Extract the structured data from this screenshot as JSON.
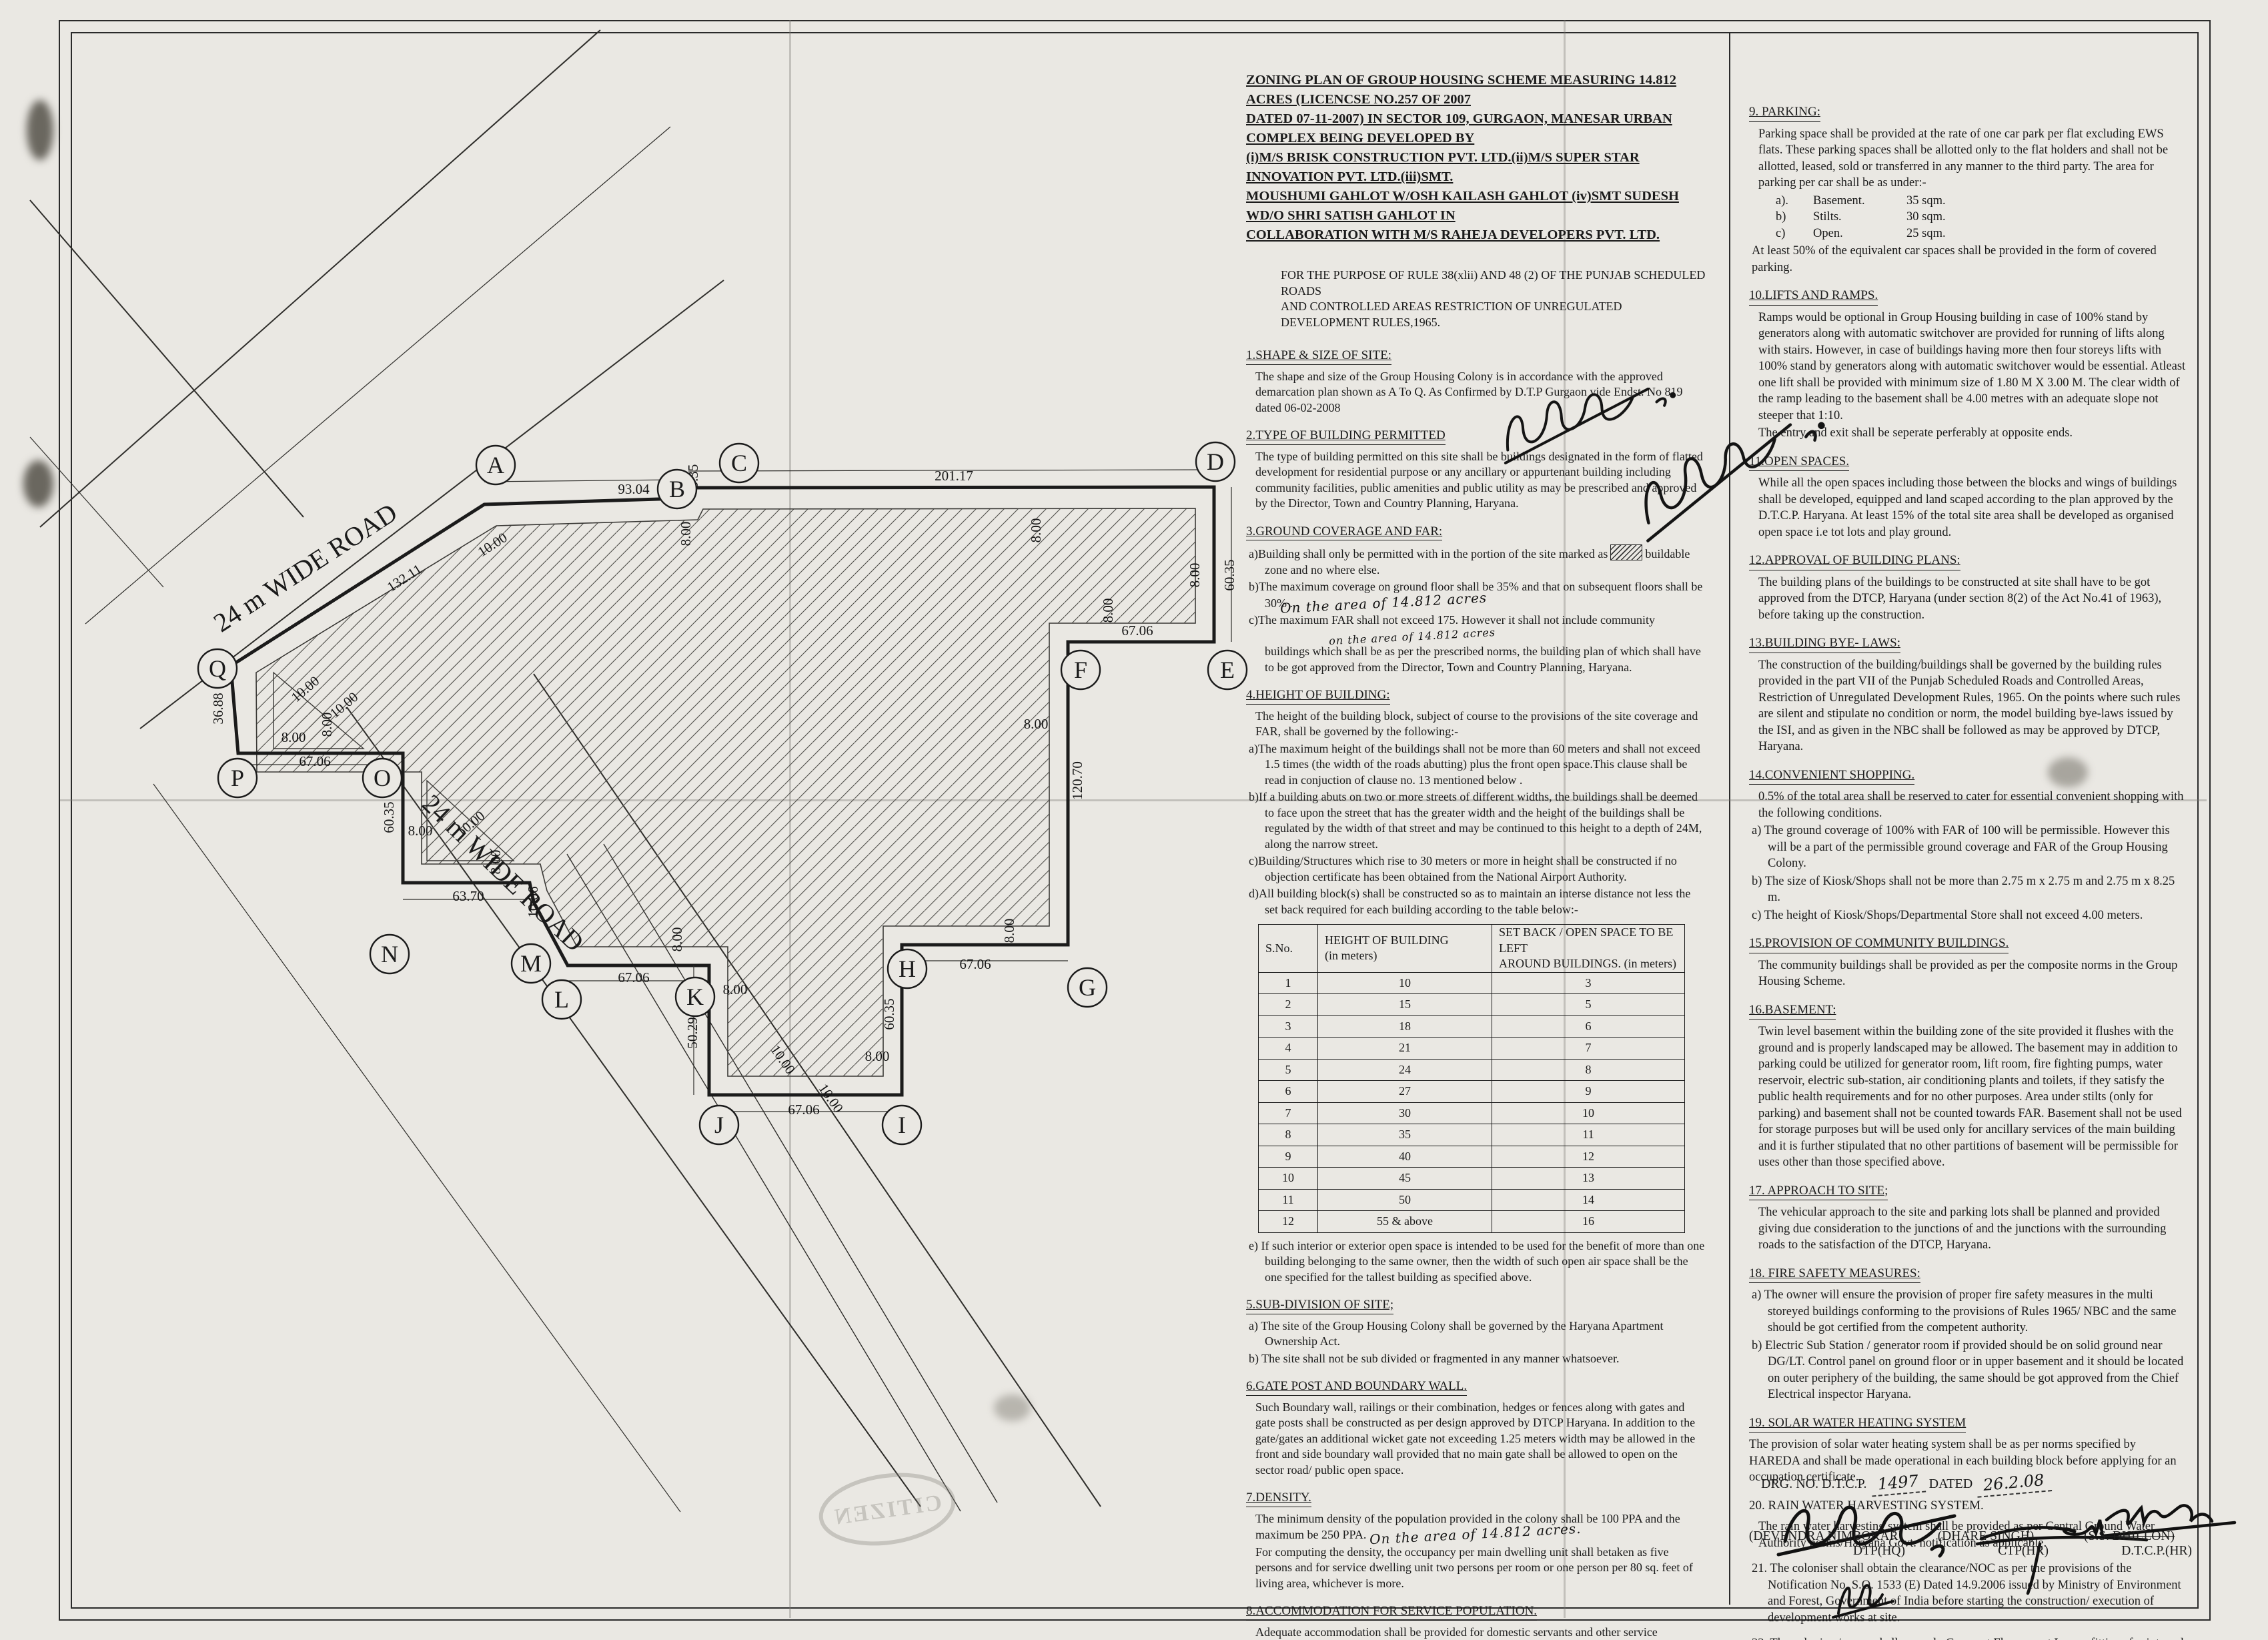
{
  "title_lines": [
    "ZONING PLAN OF GROUP HOUSING SCHEME MEASURING 14.812 ACRES (LICENCSE NO.257 OF 2007",
    "DATED 07-11-2007) IN SECTOR 109,  GURGAON, MANESAR URBAN COMPLEX BEING DEVELOPED BY",
    "(i)M/S BRISK CONSTRUCTION PVT. LTD.(ii)M/S SUPER STAR INNOVATION PVT. LTD.(iii)SMT.",
    "MOUSHUMI GAHLOT W/OSH KAILASH GAHLOT (iv)SMT SUDESH WD/O SHRI SATISH GAHLOT IN",
    "COLLABORATION WITH M/S RAHEJA DEVELOPERS PVT.  LTD."
  ],
  "intro1": "FOR THE PURPOSE OF RULE 38(xlii) AND 48 (2) OF THE PUNJAB SCHEDULED ROADS",
  "intro2": "AND CONTROLLED AREAS RESTRICTION OF UNREGULATED DEVELOPMENT RULES,1965.",
  "mid": {
    "s1h": "1.SHAPE & SIZE OF SITE:",
    "s1p": "The shape and size of the Group Housing Colony is in accordance with the approved demarcation plan shown as A To Q. As Confirmed by D.T.P Gurgaon  vide  Endst. No 819 dated 06-02-2008",
    "s2h": "2.TYPE OF BUILDING PERMITTED",
    "s2p": "The type of building permitted on this site shall be buildings designated in the form of flatted development for residential purpose or any ancillary or appurtenant building including community facilities, public amenities and public utility as may be prescribed and approved by the Director, Town and Country Planning, Haryana.",
    "s3h": "3.GROUND COVERAGE AND FAR:",
    "s3a1": "a)Building shall only be permitted with in the portion of the site marked as",
    "s3a2": "buildable zone and no where else.",
    "s3b": "b)The maximum coverage on ground floor shall be 35% and that on subsequent floors shall be 30% .",
    "s3bhw": "On the area of 14.812 acres",
    "s3c1": "c)The maximum FAR shall not exceed 175. However  it shall not include community",
    "s3chw": "on the area of 14.812 acres",
    "s3c2": "buildings which shall be as per the prescribed norms, the building plan of which shall have to be got approved from the Director, Town and Country Planning, Haryana.",
    "s4h": "4.HEIGHT OF BUILDING:",
    "s4p": "The height of the building block, subject of course to the provisions of the site coverage and FAR, shall be governed by the following:-",
    "s4a": "a)The maximum height of the buildings shall not be more than 60 meters and shall not exceed 1.5 times (the width of the roads abutting) plus the front open space.This clause shall be read in conjuction of clause no. 13 mentioned below .",
    "s4b": "b)If a building abuts on two or more streets of different widths, the buildings shall be deemed to face upon the street that has the greater width and the height of the buildings shall be regulated by the width of that street and may be continued to this height to a depth of 24M, along the narrow street.",
    "s4c": "c)Building/Structures which rise to 30 meters or more in height shall be constructed if no objection certificate has been obtained from the National Airport Authority.",
    "s4d": "d)All building block(s) shall be constructed so as to maintain an interse distance not less the set back required for each building according to the table below:-",
    "s4e": "e) If such interior or exterior open space is intended to be used for the benefit of more than one building belonging to the same owner, then the width of such open air space shall be the one specified for the tallest building as specified above.",
    "s5h": "5.SUB-DIVISION OF SITE;",
    "s5a": "a) The site of the Group Housing Colony shall be governed by the Haryana Apartment Ownership Act.",
    "s5b": "b) The site shall not be sub divided or fragmented in any manner whatsoever.",
    "s6h": "6.GATE POST AND BOUNDARY WALL.",
    "s6p": "Such Boundary wall, railings or their combination, hedges or fences along with gates and gate posts shall be constructed as per design approved by DTCP Haryana. In addition to the gate/gates an additional wicket gate not exceeding 1.25 meters width may be allowed in the front and side boundary wall provided that no main gate shall be allowed to open on the sector road/ public open space.",
    "s7h": "7.DENSITY.",
    "s7p1": "The minimum density of the population provided in the colony shall be 100 PPA and the maximum be 250 PPA.",
    "s7hw": "On the area of 14.812 acres.",
    "s7p2": "For computing the density, the occupancy per main dwelling unit shall betaken as five persons and for service dwelling unit two persons per room or one person per 80 sq. feet of living area, whichever is more.",
    "s8h": "8.ACCOMMODATION FOR SERVICE POPULATION.",
    "s8p": "Adequate accommodation shall be provided for domestic servants and other service population of EWS.  The number of such dwelling units for domestic servants shall not be less then 10 %of the number of main dwelling units and the carpet area of such a unit if attached to the main units shall not be less than 140 sq.ft.In addition 15% of the total number of dwelling units having a minimum area of 200 sq.ft shall be earmarked for E.W.S category."
  },
  "table": {
    "h0": "S.No.",
    "h1a": "HEIGHT OF BUILDING",
    "h1b": "(in meters)",
    "h2a": "SET BACK / OPEN SPACE TO BE LEFT",
    "h2b": "AROUND BUILDINGS. (in meters)",
    "rows": [
      [
        "1",
        "10",
        "3"
      ],
      [
        "2",
        "15",
        "5"
      ],
      [
        "3",
        "18",
        "6"
      ],
      [
        "4",
        "21",
        "7"
      ],
      [
        "5",
        "24",
        "8"
      ],
      [
        "6",
        "27",
        "9"
      ],
      [
        "7",
        "30",
        "10"
      ],
      [
        "8",
        "35",
        "11"
      ],
      [
        "9",
        "40",
        "12"
      ],
      [
        "10",
        "45",
        "13"
      ],
      [
        "11",
        "50",
        "14"
      ],
      [
        "12",
        "55 & above",
        "16"
      ]
    ]
  },
  "right": {
    "s9h": "9. PARKING:",
    "s9p": "Parking space shall be provided at the rate of one car park per flat excluding EWS flats. These parking spaces shall be allotted only to the flat holders and shall not be allotted, leased, sold or transferred in any manner to the third party. The area for parking per car shall be as under:-",
    "s9a1": "a).",
    "s9a2": "Basement.",
    "s9a3": "35 sqm.",
    "s9b1": "b)",
    "s9b2": "Stilts.",
    "s9b3": "30 sqm.",
    "s9c1": "c)",
    "s9c2": "Open.",
    "s9c3": "25 sqm.",
    "s9p2": "At least 50% of the equivalent car spaces shall be provided in the form of covered parking.",
    "s10h": "10.LIFTS AND RAMPS.",
    "s10p1": "Ramps would be optional in Group Housing building in case of 100% stand by generators along with automatic switchover are provided for running of lifts along with  stairs. However, in case of buildings having more then four storeys lifts with 100% stand by generators along with automatic switchover would be essential. Atleast one lift shall be provided with minimum size of 1.80 M X 3.00 M. The clear width of the ramp leading to the basement shall be 4.00 metres with an adequate slope not steeper that 1:10.",
    "s10p2": "The entry and exit shall be seperate perferably at opposite ends.",
    "s11h": "11.OPEN SPACES.",
    "s11p": "While all the open spaces including those between the blocks and wings of buildings shall be developed, equipped and land scaped  according to the plan approved by the D.T.C.P. Haryana. At least 15% of the total site area shall be developed as organised open space i.e tot lots and play ground.",
    "s12h": "12.APPROVAL OF BUILDING PLANS:",
    "s12p": "The building plans of the buildings to be constructed at site shall have to be got approved from the DTCP, Haryana (under section 8(2) of the Act No.41 of 1963), before taking up the construction.",
    "s13h": "13.BUILDING BYE- LAWS:",
    "s13p": "The construction of the building/buildings shall be governed by the building rules provided in the part VII of the Punjab Scheduled Roads and Controlled Areas, Restriction of Unregulated Development Rules, 1965. On the points where such rules are silent and stipulate no condition or norm, the model building bye-laws issued by the ISI, and as given in the NBC shall be followed as may be approved by DTCP, Haryana.",
    "s14h": "14.CONVENIENT SHOPPING.",
    "s14p": "0.5% of the total area shall be reserved to cater for essential convenient shopping with the following conditions.",
    "s14a": "a) The ground coverage of 100% with FAR of 100 will be permissible. However this will be a part of the permissible ground coverage and FAR of the Group Housing Colony.",
    "s14b": "b) The size of Kiosk/Shops shall not be more than 2.75 m x 2.75 m and 2.75 m x 8.25 m.",
    "s14c": "c) The height of Kiosk/Shops/Departmental Store shall not exceed 4.00 meters.",
    "s15h": "15.PROVISION OF COMMUNITY BUILDINGS.",
    "s15p": "The community buildings shall be provided as per the composite norms in the Group Housing Scheme.",
    "s16h": "16.BASEMENT:",
    "s16p": "Twin level basement within the building zone of the site provided it flushes with the ground and is properly landscaped may be allowed. The basement may in addition to parking could be utilized for generator room, lift room, fire fighting pumps, water reservoir, electric sub-station, air conditioning plants and toilets, if they satisfy the public health requirements and for no other purposes. Area under stilts (only for parking) and basement shall not be counted towards FAR.   Basement shall not be used for storage purposes but will be used only for ancillary services of the main building and it is further stipulated that no other partitions of basement will be permissible for uses other than those specified above.",
    "s17h": "17. APPROACH TO SITE;",
    "s17p": "The vehicular approach to the site and parking lots shall be planned and provided giving due consideration to the junctions of and the junctions with the surrounding roads to the satisfaction of the DTCP, Haryana.",
    "s18h": "18. FIRE SAFETY MEASURES:",
    "s18a": "a) The owner will ensure the provision of proper fire safety measures in the multi storeyed buildings conforming to the provisions of Rules 1965/ NBC and the same should be got certified from the competent authority.",
    "s18b": "b) Electric Sub Station / generator room if provided should be on solid ground near DG/LT. Control panel on ground floor or in upper basement and it should be located on outer periphery of the building, the same should be got approved from the Chief Electrical inspector Haryana.",
    "s19h": "19. SOLAR WATER HEATING SYSTEM",
    "s19p": "The provision of solar water heating system shall be as per norms specified by HAREDA and shall be made operational in each building block before applying for an occupation certificate.",
    "s20h": "20. RAIN WATER HARVESTING SYSTEM.",
    "s20p": "The rain water harvesting system shall be provided as per Central Ground Water Authority norms/Haryana Govt. notification as applicable.",
    "s21p": "21. The coloniser shall obtain the clearance/NOC as per the provisions of the Notification No. S.O. 1533 (E) Dated 14.9.2006 issued by Ministry of Environment and Forest, Government of India before starting the construction/ execution of development works at site.",
    "s22p": "22. The coloniser/owner shall use only Compact Fluorescent Lamps fittings for internal lighting as well as campus lighting."
  },
  "footer": {
    "drg_label": "DRG. NO. D.T.C.P.",
    "drg_no": "1497",
    "dated_label": "DATED",
    "dated": "26.2.08",
    "signers": [
      {
        "n": "(DEVENDRA NIMBOKAR)",
        "t": "DTP(HQ)"
      },
      {
        "n": "(DHARE SINGH)",
        "t": "CTP(HR)"
      },
      {
        "n": "(S.S. DHILLON)",
        "t": "D.T.C.P.(HR)"
      }
    ]
  },
  "plan": {
    "road1": "24 m WIDE ROAD",
    "road2": "24 m WIDE ROAD",
    "stamp": "CITIZEN",
    "points": [
      "A",
      "B",
      "C",
      "D",
      "E",
      "F",
      "G",
      "H",
      "I",
      "J",
      "K",
      "L",
      "M",
      "N",
      "O",
      "P",
      "Q"
    ],
    "dims": [
      "93.04",
      "3.35",
      "201.17",
      "8.00",
      "8.00",
      "8.00",
      "60.35",
      "67.06",
      "8.00",
      "8.00",
      "120.70",
      "67.06",
      "8.00",
      "8.00",
      "60.35",
      "67.06",
      "50.29",
      "8.00",
      "10.00",
      "67.06",
      "8.00",
      "10.06",
      "63.70",
      "8.00",
      "60.35",
      "8.00",
      "67.06",
      "8.00",
      "8.00",
      "36.88",
      "132.11",
      "10.00",
      "10.00",
      "10.00",
      "10.00",
      "10.00"
    ]
  }
}
